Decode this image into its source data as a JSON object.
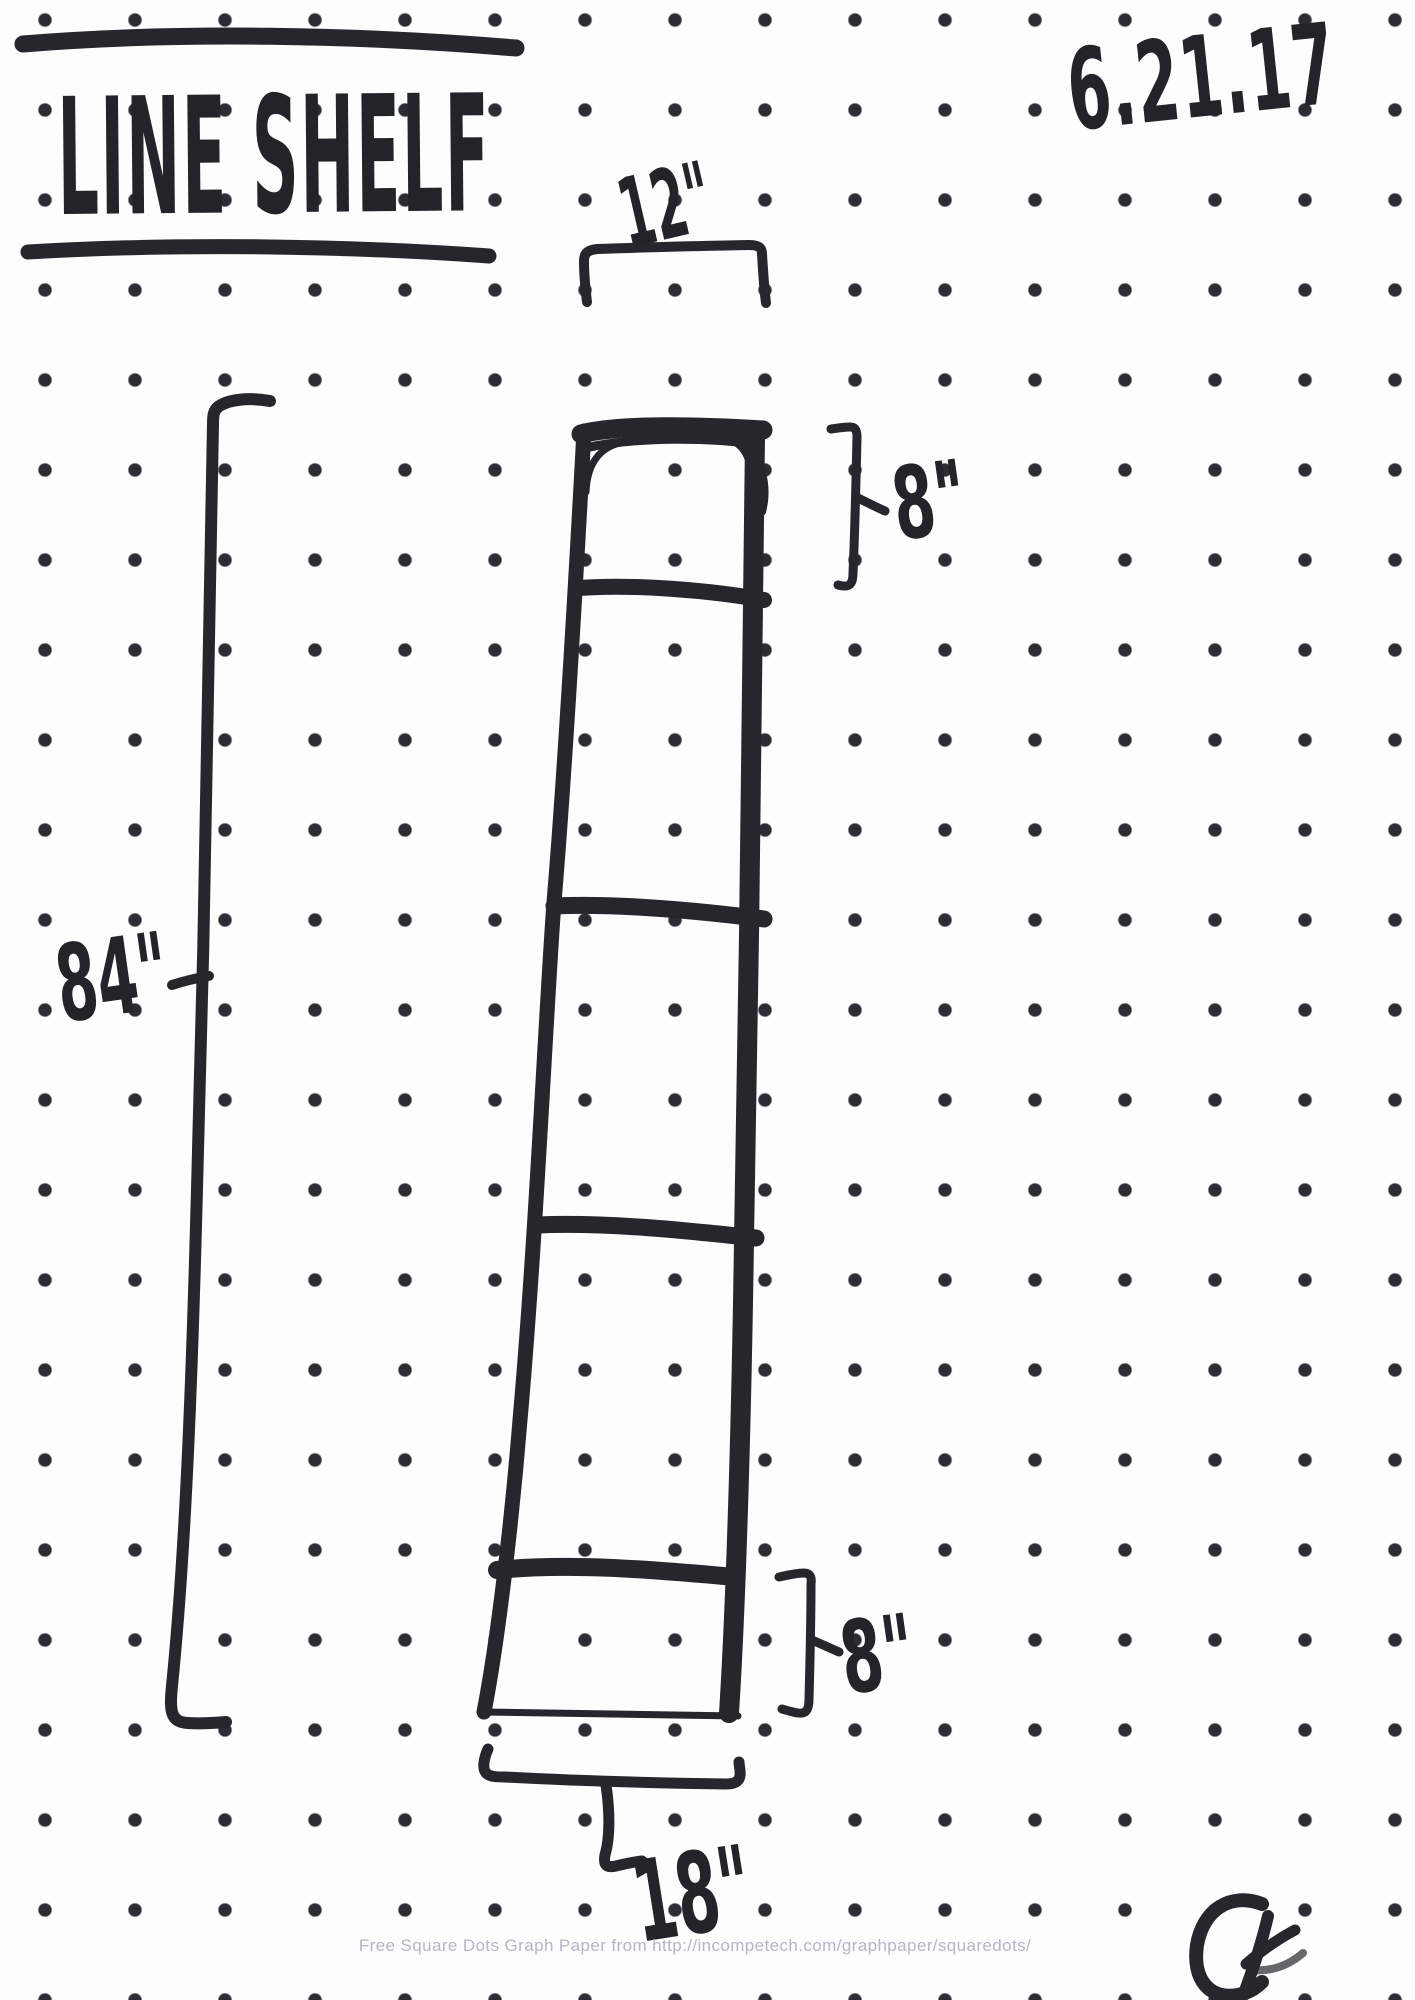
{
  "page": {
    "title": "LINE SHELF",
    "date": "6.21.17",
    "watermark": "Free Square Dots Graph Paper from http://incompetech.com/graphpaper/squaredots/"
  },
  "sketch": {
    "type": "hand-drawn tapered line-shelf elevation on square-dot graph paper",
    "dimensions": {
      "height": "84\"",
      "top_width": "12\"",
      "top_compartment": "8\"",
      "bottom_compartment": "8\"",
      "bottom_width": "18\""
    },
    "shelf": {
      "compartments": 5,
      "dividers": 4,
      "tapered": true
    }
  },
  "colors": {
    "ink": "#26262c",
    "dots": "#2c2c34",
    "paper": "#fdfdfe",
    "watermark": "#b6b5c6"
  }
}
